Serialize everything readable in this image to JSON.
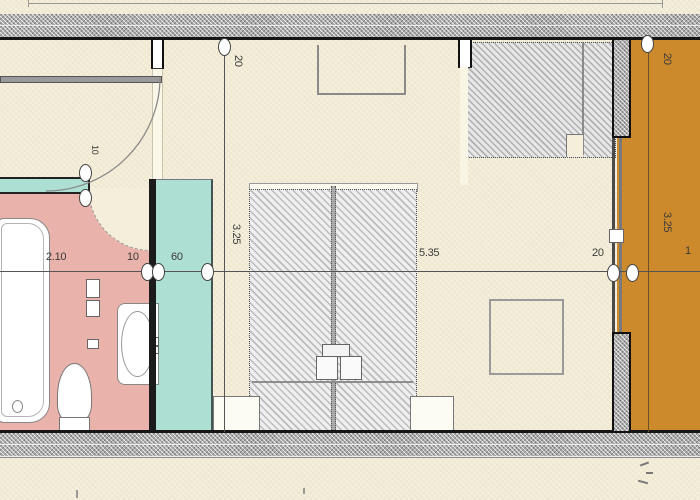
{
  "drawing": {
    "type": "architectural-floor-plan",
    "rooms": {
      "bathroom_fill": "#e9b2ab",
      "closet_fill": "#addfd2",
      "balcony_fill": "#cc8a2c",
      "background_fill": "#f4eeda"
    },
    "dims": {
      "bath_width": "2.10",
      "wall_thin": "10",
      "closet_width": "60",
      "room_width": "5.35",
      "wall_right": "20",
      "balcony_width": "1",
      "left_wall_top": "20",
      "left_room_depth": "3.25",
      "right_wall_top": "20",
      "right_room_depth": "3.25",
      "partition": "10"
    },
    "colors": {
      "wall_dark": "#1b1b1b",
      "dimension_text": "#3a3a3a",
      "furniture_outline": "#8a8a8a"
    }
  }
}
